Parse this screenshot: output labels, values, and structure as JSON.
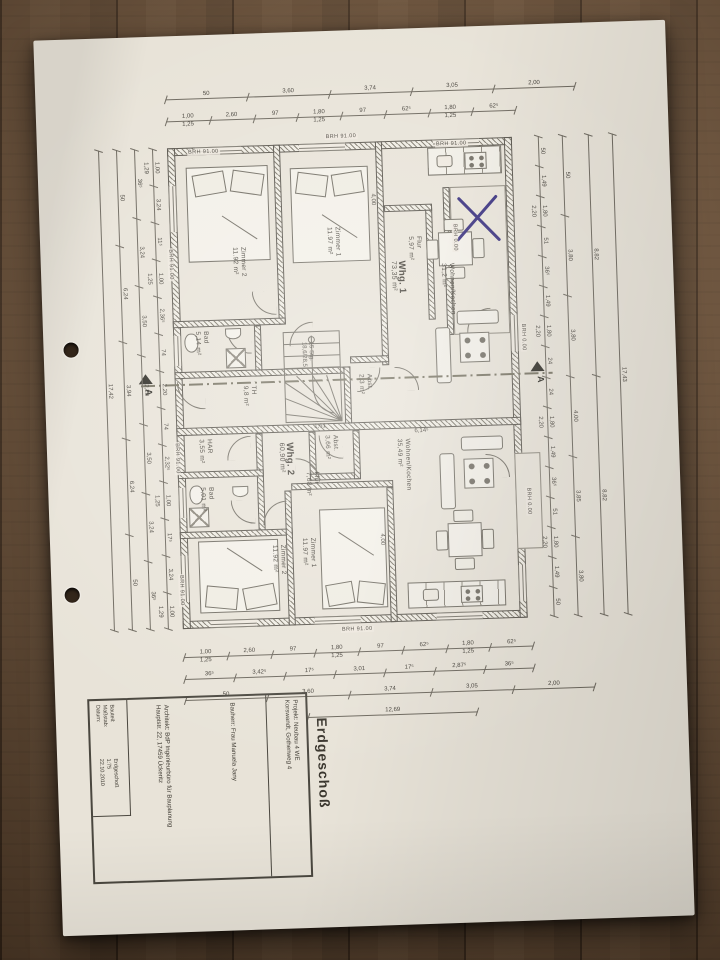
{
  "sheet": {
    "label": "Erdgeschoß"
  },
  "title_block": {
    "projekt": "Projekt:  Neubau 4 WE\nKorswandt, Gothenweg 4",
    "bauherr": "Bauherr:  Frau Manuela Jany",
    "architekt": "Architekt: BdP Ingenieurbüro für Bauplanung\nHauptstr. 22, 17459 Ückeritz",
    "fields": [
      {
        "label": "Bauteil:",
        "value": "Erdgeschoß"
      },
      {
        "label": "Maßstab:",
        "value": "1:75"
      },
      {
        "label": "Datum:",
        "value": "22.10.2010"
      }
    ]
  },
  "plan": {
    "section_label": "A",
    "rooms": [
      {
        "name": "Zimmer 2",
        "area": "11.92 m²",
        "x": 190,
        "y": 213
      },
      {
        "name": "Zimmer 1",
        "area": "11.97 m²",
        "x": 285,
        "y": 196
      },
      {
        "name": "Whg. 1",
        "area": "73,35 m²",
        "x": 348,
        "y": 232,
        "big": true
      },
      {
        "name": "Flur",
        "area": "5,97 m²",
        "x": 366,
        "y": 208
      },
      {
        "name": "Wohnen/Kochen",
        "area": "31,2 m²",
        "x": 398,
        "y": 236
      },
      {
        "name": "Bad",
        "area": "5,14 m²",
        "x": 150,
        "y": 296
      },
      {
        "name": "TH",
        "area": "9,8 m²",
        "x": 196,
        "y": 352
      },
      {
        "name": "Abst.",
        "area": "2,3 m²",
        "x": 312,
        "y": 344
      },
      {
        "name": "HAR",
        "area": "3,55 m²",
        "x": 150,
        "y": 404
      },
      {
        "name": "Bad",
        "area": "5,01 m²",
        "x": 150,
        "y": 452
      },
      {
        "name": "Whg. 2",
        "area": "60,90 m²",
        "x": 230,
        "y": 410,
        "big": true
      },
      {
        "name": "Flur",
        "area": "7,68 m²",
        "x": 256,
        "y": 440
      },
      {
        "name": "Abst.",
        "area": "3,66 m²",
        "x": 276,
        "y": 404
      },
      {
        "name": "Zimmer 2",
        "area": "11.92 m²",
        "x": 220,
        "y": 512
      },
      {
        "name": "Zimmer 1",
        "area": "11.97 m²",
        "x": 250,
        "y": 506
      },
      {
        "name": "Wohnen/Kochen",
        "area": "35,49 m²",
        "x": 348,
        "y": 410
      }
    ],
    "brh_labels": [
      {
        "text": "BRH 91.00",
        "x": 150,
        "y": 114,
        "v": false
      },
      {
        "text": "BRH 91.00",
        "x": 288,
        "y": 103,
        "v": false
      },
      {
        "text": "BRH 91.00",
        "x": 398,
        "y": 114,
        "v": false
      },
      {
        "text": "BRH 0.00",
        "x": 412,
        "y": 196,
        "v": true
      },
      {
        "text": "BRH 0.00",
        "x": 477,
        "y": 298,
        "v": true
      },
      {
        "text": "BRH 0.00",
        "x": 477,
        "y": 462,
        "v": true
      },
      {
        "text": "BRH 91.00",
        "x": 127,
        "y": 212,
        "v": true
      },
      {
        "text": "BRH 91.00",
        "x": 127,
        "y": 406,
        "v": true
      },
      {
        "text": "BRH 91.00",
        "x": 127,
        "y": 538,
        "v": true
      },
      {
        "text": "BRH 91.00",
        "x": 288,
        "y": 596,
        "v": false
      }
    ],
    "annotations": [
      {
        "text": "15 Stg.\n18,6/28,5",
        "x": 256,
        "y": 310,
        "v": true
      },
      {
        "text": "1,61",
        "x": 268,
        "y": 392,
        "v": false
      },
      {
        "text": "6,14⁵",
        "x": 368,
        "y": 400,
        "v": false
      },
      {
        "text": "4,00",
        "x": 330,
        "y": 164,
        "v": true
      },
      {
        "text": "4,00",
        "x": 328,
        "y": 504,
        "v": true
      }
    ]
  },
  "dimensions": {
    "rows": [
      {
        "x": 130,
        "y": 56,
        "w": 410,
        "values": [
          "50",
          "3,60",
          "3,74",
          "3,05",
          "2,00"
        ]
      },
      {
        "x": 130,
        "y": 78,
        "w": 350,
        "values": [
          "1,00|1,25",
          "2,60",
          "97",
          "1,80|1,25",
          "97",
          "62⁵",
          "1,80|1,25",
          "62⁵"
        ]
      },
      {
        "x": 130,
        "y": 614,
        "w": 350,
        "values": [
          "1,00|1,25",
          "2,60",
          "97",
          "1,80|1,25",
          "97",
          "62⁵",
          "1,80|1,25",
          "62⁵"
        ]
      },
      {
        "x": 130,
        "y": 636,
        "w": 350,
        "values": [
          "36⁵",
          "3,42⁵",
          "17⁵",
          "3,01",
          "17⁵",
          "2,87⁵",
          "36⁵"
        ]
      },
      {
        "x": 130,
        "y": 657,
        "w": 410,
        "values": [
          "50",
          "3,60",
          "3,74",
          "3,05",
          "2,00"
        ]
      },
      {
        "x": 252,
        "y": 678,
        "w": 170,
        "values": [
          "12,69"
        ]
      }
    ],
    "cols": [
      {
        "x": 108,
        "y": 112,
        "h": 481,
        "values": [
          "1,00|1,29",
          "3,24",
          "11⁵",
          "1,00|1,25",
          "2,36⁵",
          "74",
          "2,20",
          "74",
          "2,32⁵",
          "1,00|1,25",
          "17⁵",
          "3,24",
          "1,00|1,29"
        ]
      },
      {
        "x": 90,
        "y": 112,
        "h": 481,
        "values": [
          "36⁵",
          "3,24",
          "3,50",
          "2,20",
          "3,50",
          "3,24",
          "36⁵"
        ]
      },
      {
        "x": 72,
        "y": 112,
        "h": 481,
        "values": [
          "50",
          "6,24",
          "3,94",
          "6,24",
          "50"
        ]
      },
      {
        "x": 54,
        "y": 112,
        "h": 481,
        "values": [
          "17,42"
        ]
      },
      {
        "x": 494,
        "y": 112,
        "h": 481,
        "values": [
          "50",
          "1,49",
          "1,80|2,20",
          "51",
          "36⁵",
          "1,49",
          "1,80|2,20",
          "24",
          "24",
          "1,80|2,20",
          "1,49",
          "36⁵",
          "51",
          "1,80|2,20",
          "1,49",
          "50"
        ]
      },
      {
        "x": 518,
        "y": 112,
        "h": 481,
        "values": [
          "50",
          "3,80",
          "3,80",
          "4,00",
          "3,85",
          "3,80"
        ]
      },
      {
        "x": 544,
        "y": 112,
        "h": 481,
        "values": [
          "8,82",
          "8,82"
        ]
      },
      {
        "x": 568,
        "y": 112,
        "h": 481,
        "values": [
          "17,43"
        ]
      }
    ]
  },
  "colors": {
    "x_mark": "#342b7c",
    "ink": "#45423a",
    "paper": "#e8e3d8",
    "wood": "#6e5137"
  }
}
